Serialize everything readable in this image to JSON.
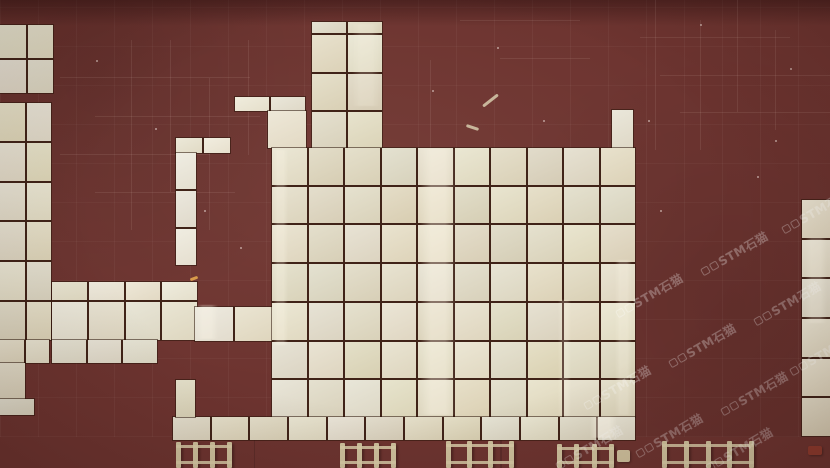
{
  "palette": {
    "floor_maroon": "#6d3430",
    "floor_maroon_dark": "#54261f",
    "tile_cream": "#e4dcc3",
    "tile_cream_light": "#f0ead7",
    "grout_dark": "#402318",
    "concrete_grey": "#7c7c72",
    "concrete_dark": "#64645c",
    "wood_tan": "#cfc19d",
    "red_object": "#8f3b2e"
  },
  "watermark": {
    "text": "STM石猫",
    "logo_box_count": 2,
    "color": "#ffffff",
    "opacity": 0.28,
    "rotation_deg": -30,
    "positions": [
      [
        652,
        298
      ],
      [
        737,
        256
      ],
      [
        818,
        214
      ],
      [
        620,
        390
      ],
      [
        705,
        348
      ],
      [
        790,
        306
      ],
      [
        672,
        438
      ],
      [
        757,
        396
      ],
      [
        826,
        356
      ],
      [
        592,
        450
      ],
      [
        742,
        452
      ]
    ]
  },
  "tile_blocks": [
    {
      "name": "left-upper-block",
      "x": 0,
      "y": 25,
      "w": 53,
      "h": 68,
      "cols": 2,
      "rows": 2,
      "light": false
    },
    {
      "name": "left-main-block",
      "x": 0,
      "y": 103,
      "w": 51,
      "h": 237,
      "cols": 2,
      "rows": 6,
      "light": false
    },
    {
      "name": "left-step-1",
      "x": 0,
      "y": 340,
      "w": 49,
      "h": 23,
      "cols": 2,
      "rows": 1,
      "light": false
    },
    {
      "name": "left-step-2",
      "x": 0,
      "y": 363,
      "w": 25,
      "h": 36,
      "cols": 1,
      "rows": 1,
      "light": false
    },
    {
      "name": "left-step-3",
      "x": 0,
      "y": 399,
      "w": 34,
      "h": 16,
      "cols": 1,
      "rows": 1,
      "light": false
    },
    {
      "name": "mid-block",
      "x": 52,
      "y": 282,
      "w": 145,
      "h": 58,
      "cols": 4,
      "rows": 2,
      "light": true,
      "row_template": "18px 1fr"
    },
    {
      "name": "mid-block-bottom",
      "x": 52,
      "y": 340,
      "w": 105,
      "h": 23,
      "cols": 3,
      "rows": 1,
      "light": true
    },
    {
      "name": "mid-arm",
      "x": 195,
      "y": 307,
      "w": 77,
      "h": 34,
      "cols": 2,
      "rows": 1,
      "light": true
    },
    {
      "name": "ell-bar",
      "x": 176,
      "y": 138,
      "w": 54,
      "h": 15,
      "cols": 2,
      "rows": 1,
      "light": true
    },
    {
      "name": "ell-strip",
      "x": 176,
      "y": 153,
      "w": 20,
      "h": 112,
      "cols": 1,
      "rows": 3,
      "light": true
    },
    {
      "name": "step-bar",
      "x": 235,
      "y": 97,
      "w": 70,
      "h": 14,
      "cols": 2,
      "rows": 1,
      "light": true
    },
    {
      "name": "step-strip",
      "x": 268,
      "y": 111,
      "w": 38,
      "h": 37,
      "cols": 1,
      "rows": 1,
      "light": true
    },
    {
      "name": "tower",
      "x": 312,
      "y": 22,
      "w": 70,
      "h": 126,
      "cols": 2,
      "rows": 4,
      "light": false,
      "row_template": "11px 37px 36px 1fr"
    },
    {
      "name": "lone-tile",
      "x": 612,
      "y": 110,
      "w": 21,
      "h": 38,
      "cols": 1,
      "rows": 1,
      "light": true
    },
    {
      "name": "main-field",
      "x": 272,
      "y": 148,
      "w": 363,
      "h": 269,
      "cols": 10,
      "rows": 7,
      "light": false
    },
    {
      "name": "bottom-row",
      "x": 173,
      "y": 417,
      "w": 462,
      "h": 23,
      "cols": 12,
      "rows": 1,
      "light": false
    },
    {
      "name": "connector-tile",
      "x": 176,
      "y": 380,
      "w": 19,
      "h": 37,
      "cols": 1,
      "rows": 1,
      "light": false
    },
    {
      "name": "right-strip",
      "x": 802,
      "y": 200,
      "w": 28,
      "h": 236,
      "cols": 1,
      "rows": 6,
      "light": false
    }
  ],
  "gloss_streaks": [
    {
      "x": 420,
      "y": 149,
      "w": 36,
      "h": 266,
      "o": 0.45
    },
    {
      "x": 273,
      "y": 150,
      "w": 15,
      "h": 195,
      "o": 0.3
    },
    {
      "x": 615,
      "y": 260,
      "w": 17,
      "h": 155,
      "o": 0.28
    },
    {
      "x": 558,
      "y": 300,
      "w": 13,
      "h": 116,
      "o": 0.22
    },
    {
      "x": 805,
      "y": 238,
      "w": 22,
      "h": 85,
      "o": 0.3
    },
    {
      "x": 196,
      "y": 305,
      "w": 22,
      "h": 34,
      "o": 0.35
    },
    {
      "x": 590,
      "y": 417,
      "w": 27,
      "h": 21,
      "o": 0.6
    },
    {
      "x": 352,
      "y": 24,
      "w": 28,
      "h": 82,
      "o": 0.22
    }
  ],
  "scratch_marks": [
    {
      "x": 131,
      "y": 40,
      "w": 1,
      "h": 190
    },
    {
      "x": 170,
      "y": 40,
      "w": 1,
      "h": 152
    },
    {
      "x": 209,
      "y": 78,
      "w": 1,
      "h": 152
    },
    {
      "x": 248,
      "y": 40,
      "w": 1,
      "h": 115
    },
    {
      "x": 60,
      "y": 77,
      "w": 190,
      "h": 1
    },
    {
      "x": 95,
      "y": 116,
      "w": 165,
      "h": 1
    },
    {
      "x": 60,
      "y": 154,
      "w": 150,
      "h": 1
    },
    {
      "x": 95,
      "y": 192,
      "w": 140,
      "h": 1
    },
    {
      "x": 655,
      "y": 0,
      "w": 1,
      "h": 150
    },
    {
      "x": 700,
      "y": 20,
      "w": 1,
      "h": 130
    },
    {
      "x": 737,
      "y": 0,
      "w": 1,
      "h": 112
    },
    {
      "x": 775,
      "y": 30,
      "w": 1,
      "h": 100
    },
    {
      "x": 640,
      "y": 37,
      "w": 150,
      "h": 1
    },
    {
      "x": 660,
      "y": 75,
      "w": 170,
      "h": 1
    },
    {
      "x": 680,
      "y": 112,
      "w": 150,
      "h": 1
    },
    {
      "x": 430,
      "y": 60,
      "w": 1,
      "h": 90
    },
    {
      "x": 460,
      "y": 20,
      "w": 120,
      "h": 1
    },
    {
      "x": 500,
      "y": 58,
      "w": 90,
      "h": 1
    }
  ],
  "specks": [
    [
      14,
      43
    ],
    [
      155,
      128
    ],
    [
      297,
      155
    ],
    [
      372,
      232
    ],
    [
      432,
      90
    ],
    [
      497,
      47
    ],
    [
      543,
      120
    ],
    [
      586,
      151
    ],
    [
      611,
      214
    ],
    [
      648,
      120
    ],
    [
      700,
      24
    ],
    [
      757,
      176
    ],
    [
      790,
      68
    ],
    [
      520,
      355
    ],
    [
      240,
      247
    ],
    [
      120,
      327
    ],
    [
      660,
      210
    ],
    [
      775,
      140
    ],
    [
      96,
      60
    ],
    [
      204,
      210
    ]
  ],
  "debris": [
    {
      "x": 481,
      "y": 99,
      "len": 19,
      "rot": -38,
      "color": "#c8b69b"
    },
    {
      "x": 466,
      "y": 126,
      "len": 13,
      "rot": 18,
      "color": "#c8b69b"
    },
    {
      "x": 190,
      "y": 277,
      "len": 8,
      "rot": -20,
      "color": "#d89a4a"
    }
  ],
  "trestles": [
    {
      "x": 176,
      "y": 442,
      "w": 56,
      "h": 26
    },
    {
      "x": 340,
      "y": 443,
      "w": 56,
      "h": 25
    },
    {
      "x": 446,
      "y": 441,
      "w": 68,
      "h": 27
    },
    {
      "x": 557,
      "y": 444,
      "w": 57,
      "h": 24
    },
    {
      "x": 662,
      "y": 441,
      "w": 92,
      "h": 27
    }
  ],
  "small_objects": [
    {
      "name": "wood-stake",
      "x": 617,
      "y": 450,
      "w": 13,
      "h": 12,
      "color": "#cfc19d"
    },
    {
      "name": "red-debris",
      "x": 808,
      "y": 446,
      "w": 14,
      "h": 9,
      "color": "#8f3b2e"
    }
  ],
  "concrete_seams": [
    {
      "x": 500,
      "y": 437,
      "w": 2,
      "h": 31
    },
    {
      "x": 254,
      "y": 440,
      "w": 1,
      "h": 28
    }
  ]
}
